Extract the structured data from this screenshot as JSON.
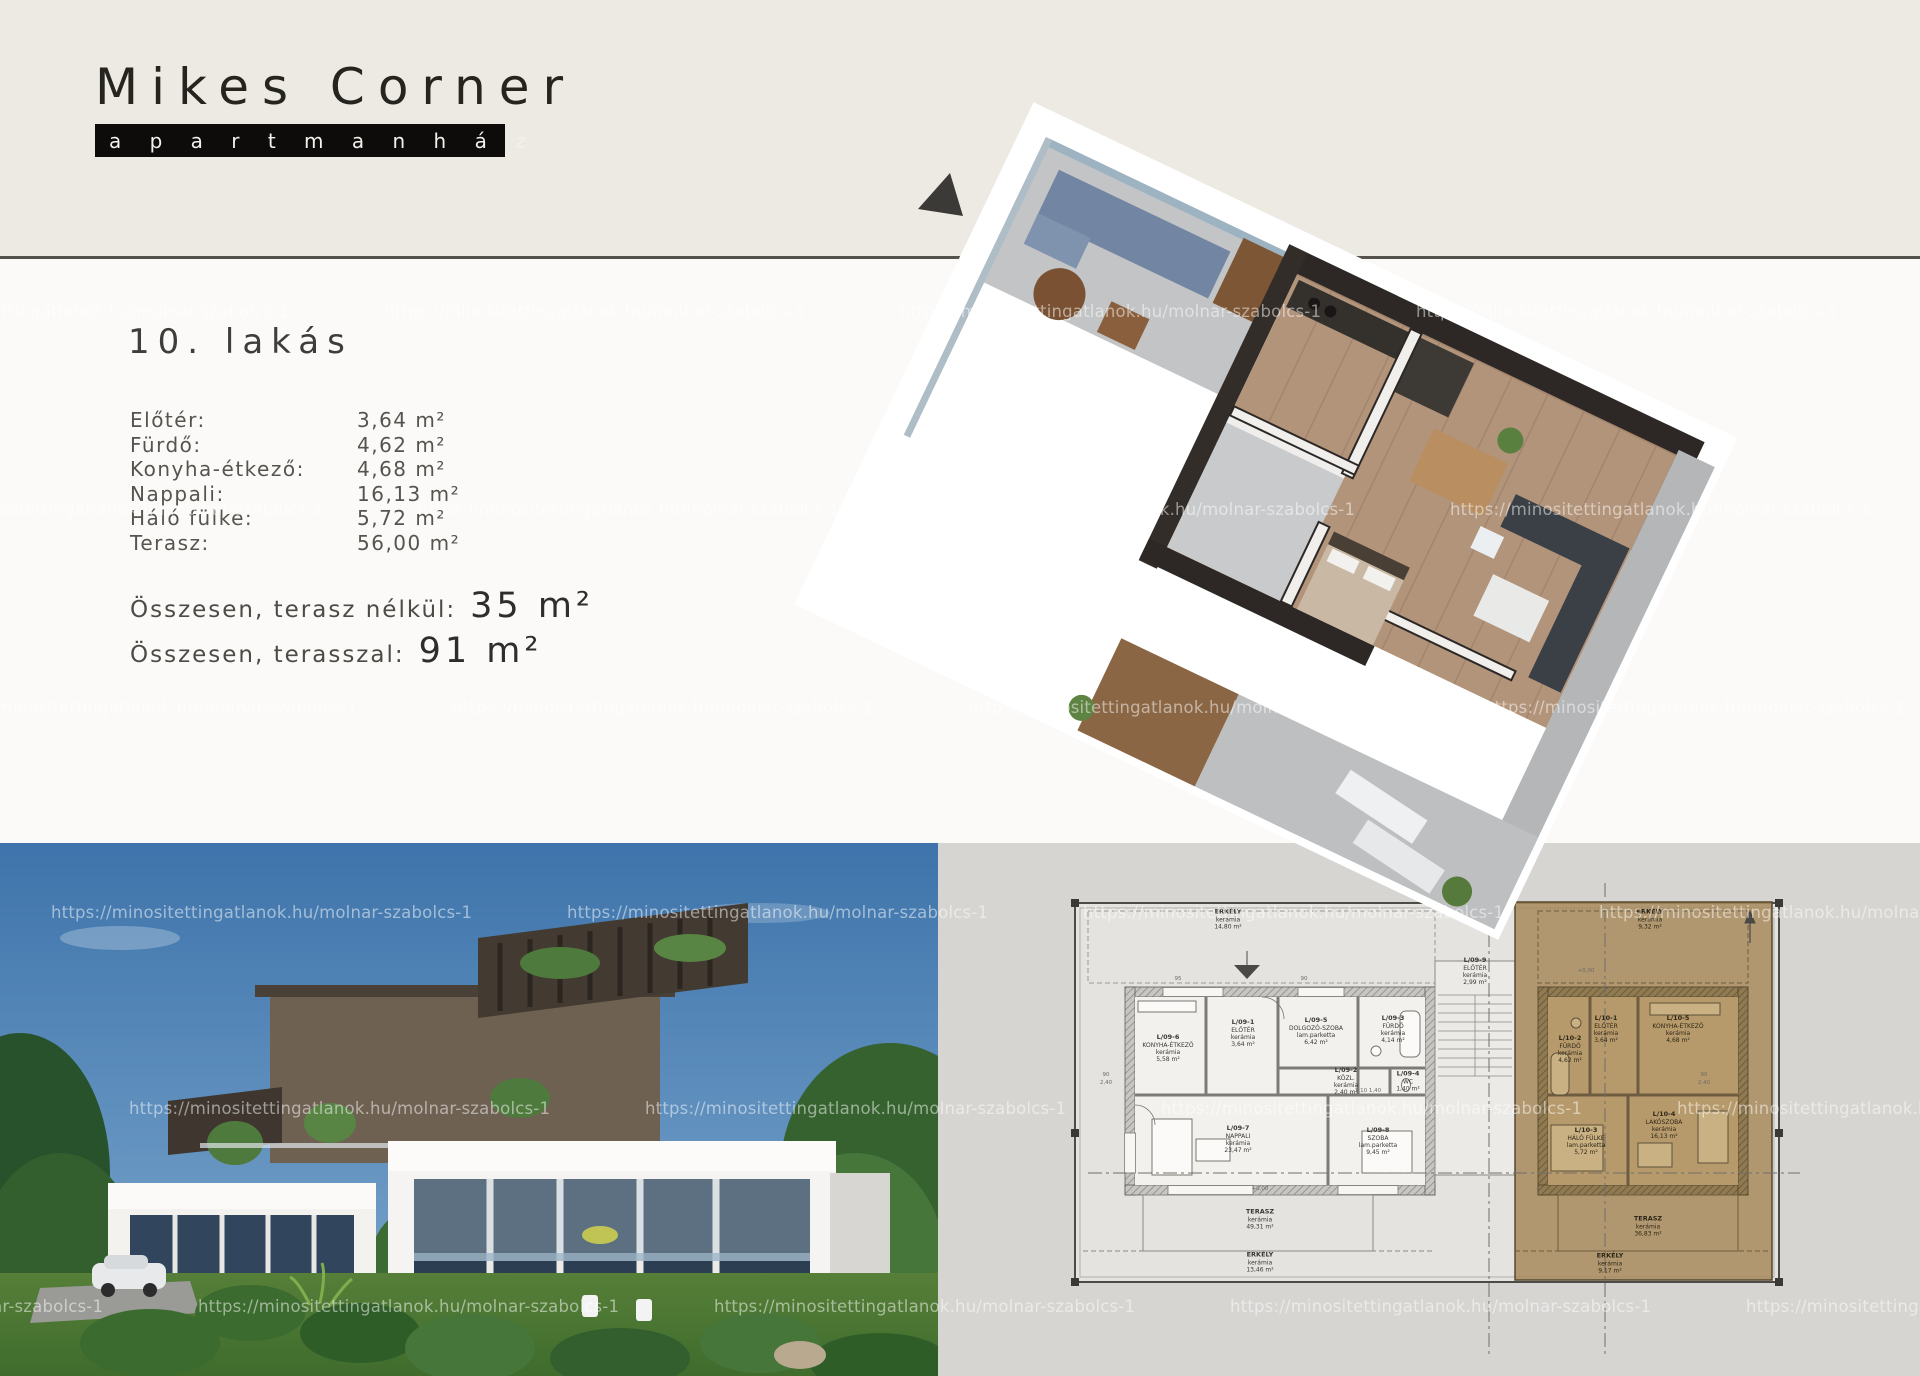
{
  "logo": {
    "title": "Mikes Corner",
    "subtitle": "a p a r t m a n h á z"
  },
  "apartment": {
    "title": "10. lakás",
    "rooms": [
      {
        "label": "Előtér:",
        "value": "3,64 m²"
      },
      {
        "label": "Fürdő:",
        "value": "4,62 m²"
      },
      {
        "label": "Konyha-étkező:",
        "value": "4,68 m²"
      },
      {
        "label": "Nappali:",
        "value": "16,13 m²"
      },
      {
        "label": "Háló fülke:",
        "value": "5,72 m²"
      },
      {
        "label": "Terasz:",
        "value": "56,00 m²"
      }
    ],
    "totals": [
      {
        "label": "Összesen, terasz nélkül:",
        "value": "35 m²"
      },
      {
        "label": "Összesen, terasszal:",
        "value": "91 m²"
      }
    ]
  },
  "watermark": {
    "text": "https://minositettingatlanok.hu/molnar-szabolcs-1",
    "rows": [
      {
        "y": 302,
        "xs": [
          -132,
          384,
          900,
          1416
        ]
      },
      {
        "y": 500,
        "xs": [
          -98,
          418,
          934,
          1450
        ]
      },
      {
        "y": 698,
        "xs": [
          -64,
          452,
          968,
          1484
        ]
      },
      {
        "y": 903,
        "xs": [
          51,
          567,
          1083,
          1599
        ]
      },
      {
        "y": 1099,
        "xs": [
          129,
          645,
          1161,
          1677
        ]
      },
      {
        "y": 1297,
        "xs": [
          -318,
          198,
          714,
          1230,
          1746
        ]
      }
    ]
  },
  "floorplan": {
    "rooms": [
      {
        "x": 290,
        "y": 76,
        "lines": [
          "ERKÉLY",
          "kerámia",
          "14,80 m²"
        ]
      },
      {
        "x": 712,
        "y": 76,
        "lines": [
          "ERKÉLY",
          "kerámia",
          "9,32 m²"
        ],
        "dark": true
      },
      {
        "x": 230,
        "y": 205,
        "lines": [
          "L/09-6",
          "KONYHA-ÉTKEZŐ",
          "kerámia",
          "5,58 m²"
        ]
      },
      {
        "x": 305,
        "y": 190,
        "lines": [
          "L/09-1",
          "ELŐTÉR",
          "kerámia",
          "3,64 m²"
        ]
      },
      {
        "x": 378,
        "y": 188,
        "lines": [
          "L/09-5",
          "DOLGOZÓ-SZOBA",
          "lam.parketta",
          "6,42 m²"
        ]
      },
      {
        "x": 455,
        "y": 186,
        "lines": [
          "L/09-3",
          "FÜRDŐ",
          "kerámia",
          "4,14 m²"
        ]
      },
      {
        "x": 408,
        "y": 238,
        "lines": [
          "L/09-2",
          "KÖZL.",
          "kerámia",
          "2,40 m²"
        ]
      },
      {
        "x": 470,
        "y": 238,
        "lines": [
          "L/09-4",
          "WC",
          "1,40 m²"
        ]
      },
      {
        "x": 300,
        "y": 296,
        "lines": [
          "L/09-7",
          "NAPPALI",
          "kerámia",
          "23,47 m²"
        ]
      },
      {
        "x": 440,
        "y": 298,
        "lines": [
          "L/09-8",
          "SZOBA",
          "lam.parketta",
          "9,45 m²"
        ]
      },
      {
        "x": 537,
        "y": 128,
        "lines": [
          "L/09-9",
          "ELŐTÉR",
          "kerámia",
          "2,99 m²"
        ]
      },
      {
        "x": 322,
        "y": 376,
        "lines": [
          "TERASZ",
          "kerámia",
          "49,31 m²"
        ]
      },
      {
        "x": 322,
        "y": 419,
        "lines": [
          "ERKÉLY",
          "kerámia",
          "13,46 m²"
        ]
      },
      {
        "x": 632,
        "y": 206,
        "lines": [
          "L/10-2",
          "FÜRDŐ",
          "kerámia",
          "4,62 m²"
        ],
        "dark": true
      },
      {
        "x": 668,
        "y": 186,
        "lines": [
          "L/10-1",
          "ELŐTÉR",
          "kerámia",
          "3,64 m²"
        ],
        "dark": true
      },
      {
        "x": 740,
        "y": 186,
        "lines": [
          "L/10-5",
          "KONYHA-ÉTKEZŐ",
          "kerámia",
          "4,68 m²"
        ],
        "dark": true
      },
      {
        "x": 648,
        "y": 298,
        "lines": [
          "L/10-3",
          "HÁLÓ FÜLKE",
          "lam.parketta",
          "5,72 m²"
        ],
        "dark": true
      },
      {
        "x": 726,
        "y": 282,
        "lines": [
          "L/10-4",
          "LAKÓSZOBA",
          "kerámia",
          "16,13 m²"
        ],
        "dark": true
      },
      {
        "x": 710,
        "y": 383,
        "lines": [
          "TERASZ",
          "kerámia",
          "36,83 m²"
        ],
        "dark": true
      },
      {
        "x": 672,
        "y": 420,
        "lines": [
          "ERKÉLY",
          "kerámia",
          "9,17 m²"
        ],
        "dark": true
      }
    ],
    "dims": [
      {
        "x": 168,
        "y": 232,
        "t": "90"
      },
      {
        "x": 168,
        "y": 240,
        "t": "2,40"
      },
      {
        "x": 240,
        "y": 136,
        "t": "95"
      },
      {
        "x": 366,
        "y": 136,
        "t": "90"
      },
      {
        "x": 430,
        "y": 248,
        "t": "2,10  1,40"
      },
      {
        "x": 766,
        "y": 232,
        "t": "90"
      },
      {
        "x": 766,
        "y": 240,
        "t": "2,40"
      },
      {
        "x": 322,
        "y": 346,
        "t": "+0,00"
      },
      {
        "x": 648,
        "y": 128,
        "t": "+0,00"
      }
    ]
  },
  "colors": {
    "cream": "#edeae3",
    "divider": "#55524c",
    "logo_bar": "#0d0c0a",
    "plan_bg": "#d6d5d2",
    "plan_paper": "#e4e3e0",
    "highlight_brown": "#a8895a",
    "sky": "#3e74ab",
    "lawn": "#4c7b36",
    "wood_floor": "#b2947b",
    "dark_wall": "#2d2825"
  }
}
